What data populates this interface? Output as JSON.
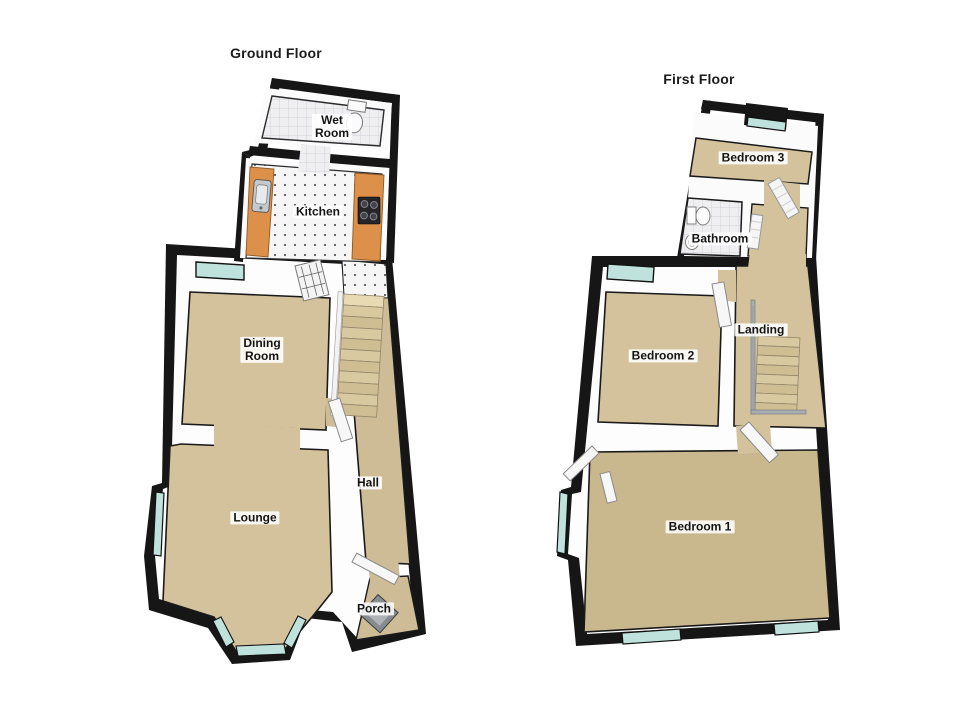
{
  "ground_floor": {
    "title": "Ground Floor",
    "rooms": {
      "wet_room": {
        "label": "Wet\nRoom"
      },
      "kitchen": {
        "label": "Kitchen"
      },
      "dining_room": {
        "label": "Dining\nRoom"
      },
      "hall": {
        "label": "Hall"
      },
      "lounge": {
        "label": "Lounge"
      },
      "porch": {
        "label": "Porch"
      }
    }
  },
  "first_floor": {
    "title": "First Floor",
    "rooms": {
      "bedroom_3": {
        "label": "Bedroom 3"
      },
      "bathroom": {
        "label": "Bathroom"
      },
      "bedroom_2": {
        "label": "Bedroom 2"
      },
      "landing": {
        "label": "Landing"
      },
      "bedroom_1": {
        "label": "Bedroom 1"
      }
    }
  },
  "colors": {
    "wall": "#161616",
    "interior_wall": "#fdfdfd",
    "carpet": "#d3c29c",
    "carpet_dark": "#c9b88e",
    "tile": "#ededf0",
    "kitchen_counter": "#dd9049",
    "window_glass": "#bfe3dc",
    "stairs": "#d8c89e",
    "railing": "#a7adb2",
    "door": "#f5f5f5",
    "mat": "#878c90"
  }
}
